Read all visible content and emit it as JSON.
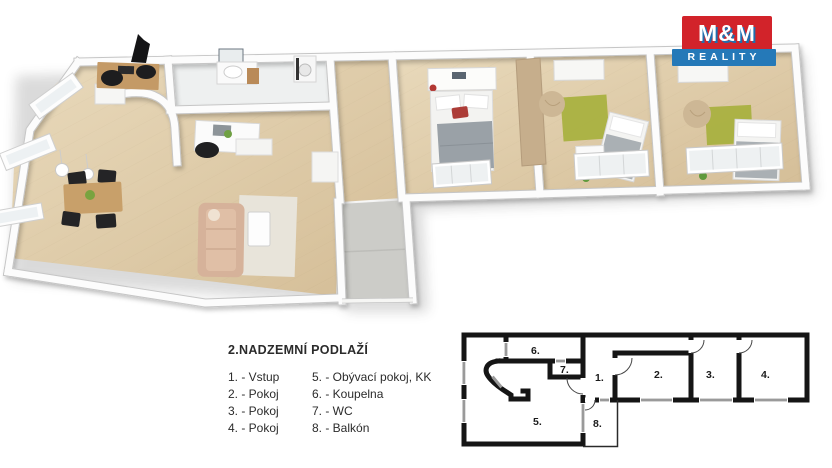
{
  "brand": {
    "name": "M&M",
    "sub": "REALITY",
    "red": "#d2232a",
    "blue": "#2579b8"
  },
  "floor_title": "2.NADZEMNÍ PODLAŽÍ",
  "legend": {
    "col1": [
      "1. - Vstup",
      "2. - Pokoj",
      "3. - Pokoj",
      "4. - Pokoj"
    ],
    "col2": [
      "5. - Obývací pokoj, KK",
      "6. - Koupelna",
      "7. - WC",
      "8. - Balkón"
    ]
  },
  "plan2d": {
    "room_numbers": [
      "1.",
      "2.",
      "3.",
      "4.",
      "5.",
      "6.",
      "7.",
      "8."
    ]
  },
  "palette": {
    "floor_wood": "#e2d0ac",
    "rug_green": "#a9b140",
    "sofa_beige": "#d6b29a",
    "blanket_gray": "#9aa1a7",
    "accent_red": "#b03a36",
    "balcony_gray": "#ccccc8",
    "wall_line_black": "#151515",
    "window_gray": "#9a9a9a"
  }
}
